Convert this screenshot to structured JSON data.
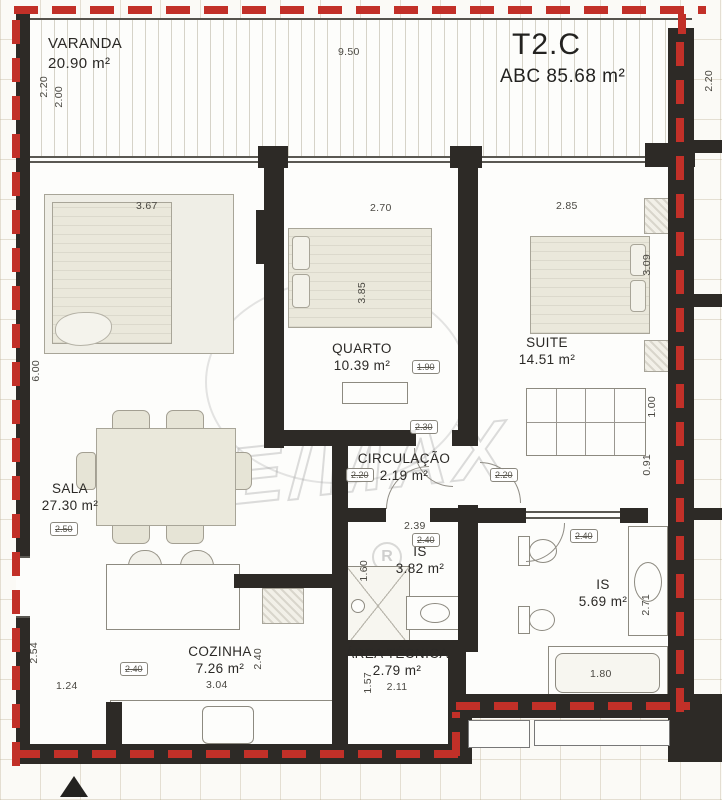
{
  "plan": {
    "unit": "T2.C",
    "abc": "ABC 85.68 m²",
    "watermark": "RE/MAX",
    "watermark_r": "R"
  },
  "rooms": {
    "varanda": {
      "name": "VARANDA",
      "area": "20.90 m²"
    },
    "sala": {
      "name": "SALA",
      "area": "27.30 m²"
    },
    "quarto": {
      "name": "QUARTO",
      "area": "10.39 m²"
    },
    "suite": {
      "name": "SUITE",
      "area": "14.51 m²"
    },
    "circulacao": {
      "name": "CIRCULAÇÃO",
      "area": "2.19 m²"
    },
    "is1": {
      "name": "IS",
      "area": "3.82 m²"
    },
    "is2": {
      "name": "IS",
      "area": "5.69 m²"
    },
    "cozinha": {
      "name": "COZINHA",
      "area": "7.26 m²"
    },
    "area_tecnica": {
      "name": "ÁREA TÉCNICA",
      "area": "2.79 m²"
    }
  },
  "dims": {
    "balcony_width": "9.50",
    "balcony_left_a": "2.20",
    "balcony_left_b": "2.00",
    "right_top": "2.20",
    "sala_top": "3.67",
    "sala_left": "6.00",
    "sala_box": "2.50",
    "quarto_top": "2.70",
    "quarto_height": "3.85",
    "quarto_box": "1.90",
    "suite_top": "2.85",
    "suite_height": "3.09",
    "suite_shelf_a": "1.00",
    "suite_shelf_b": "0.91",
    "circ_box_left": "2.20",
    "circ_box_right": "2.20",
    "circ_top_box": "2.30",
    "is1_width": "2.39",
    "is1_box": "2.40",
    "is1_height": "1.60",
    "is2_box": "2.40",
    "is2_height": "2.71",
    "bathtub": "1.80",
    "cozinha_box": "2.40",
    "cozinha_height": "2.40",
    "cozinha_width": "3.04",
    "at_width": "2.11",
    "at_height": "1.57",
    "entry_left": "2.54",
    "entry_width": "1.24"
  },
  "colors": {
    "boundary_red": "#c23028",
    "wall_black": "#2d2a26",
    "furniture_fill": "#eae8db",
    "hatch_gray": "#d6d3c8",
    "grid_line": "#ddd6c6"
  }
}
